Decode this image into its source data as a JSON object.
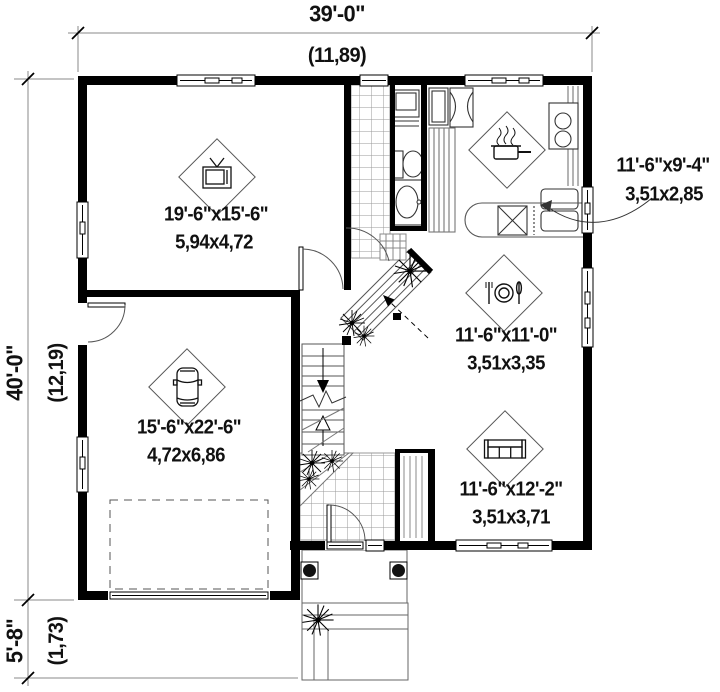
{
  "plan": {
    "dimensions": {
      "top_imperial": "39'-0\"",
      "top_metric": "(11,89)",
      "left_imperial": "40'-0\"",
      "left_metric": "(12,19)",
      "stoop_imperial": "5'-8\"",
      "stoop_metric": "(1,73)"
    },
    "rooms": {
      "living": {
        "imperial": "19'-6\"x15'-6\"",
        "metric": "5,94x4,72",
        "icon": "tv-icon"
      },
      "garage": {
        "imperial": "15'-6\"x22'-6\"",
        "metric": "4,72x6,86",
        "icon": "car-icon"
      },
      "kitchen": {
        "imperial": "11'-6\"x9'-4\"",
        "metric": "3,51x2,85",
        "icon": "cooking-pot-icon"
      },
      "dining": {
        "imperial": "11'-6\"x11'-0\"",
        "metric": "3,51x3,35",
        "icon": "plate-cutlery-icon"
      },
      "family": {
        "imperial": "11'-6\"x12'-2\"",
        "metric": "3,51x3,71",
        "icon": "sofa-icon"
      }
    },
    "colors": {
      "wall": "#000000",
      "line": "#555555",
      "text": "#111111",
      "background": "#ffffff"
    }
  }
}
